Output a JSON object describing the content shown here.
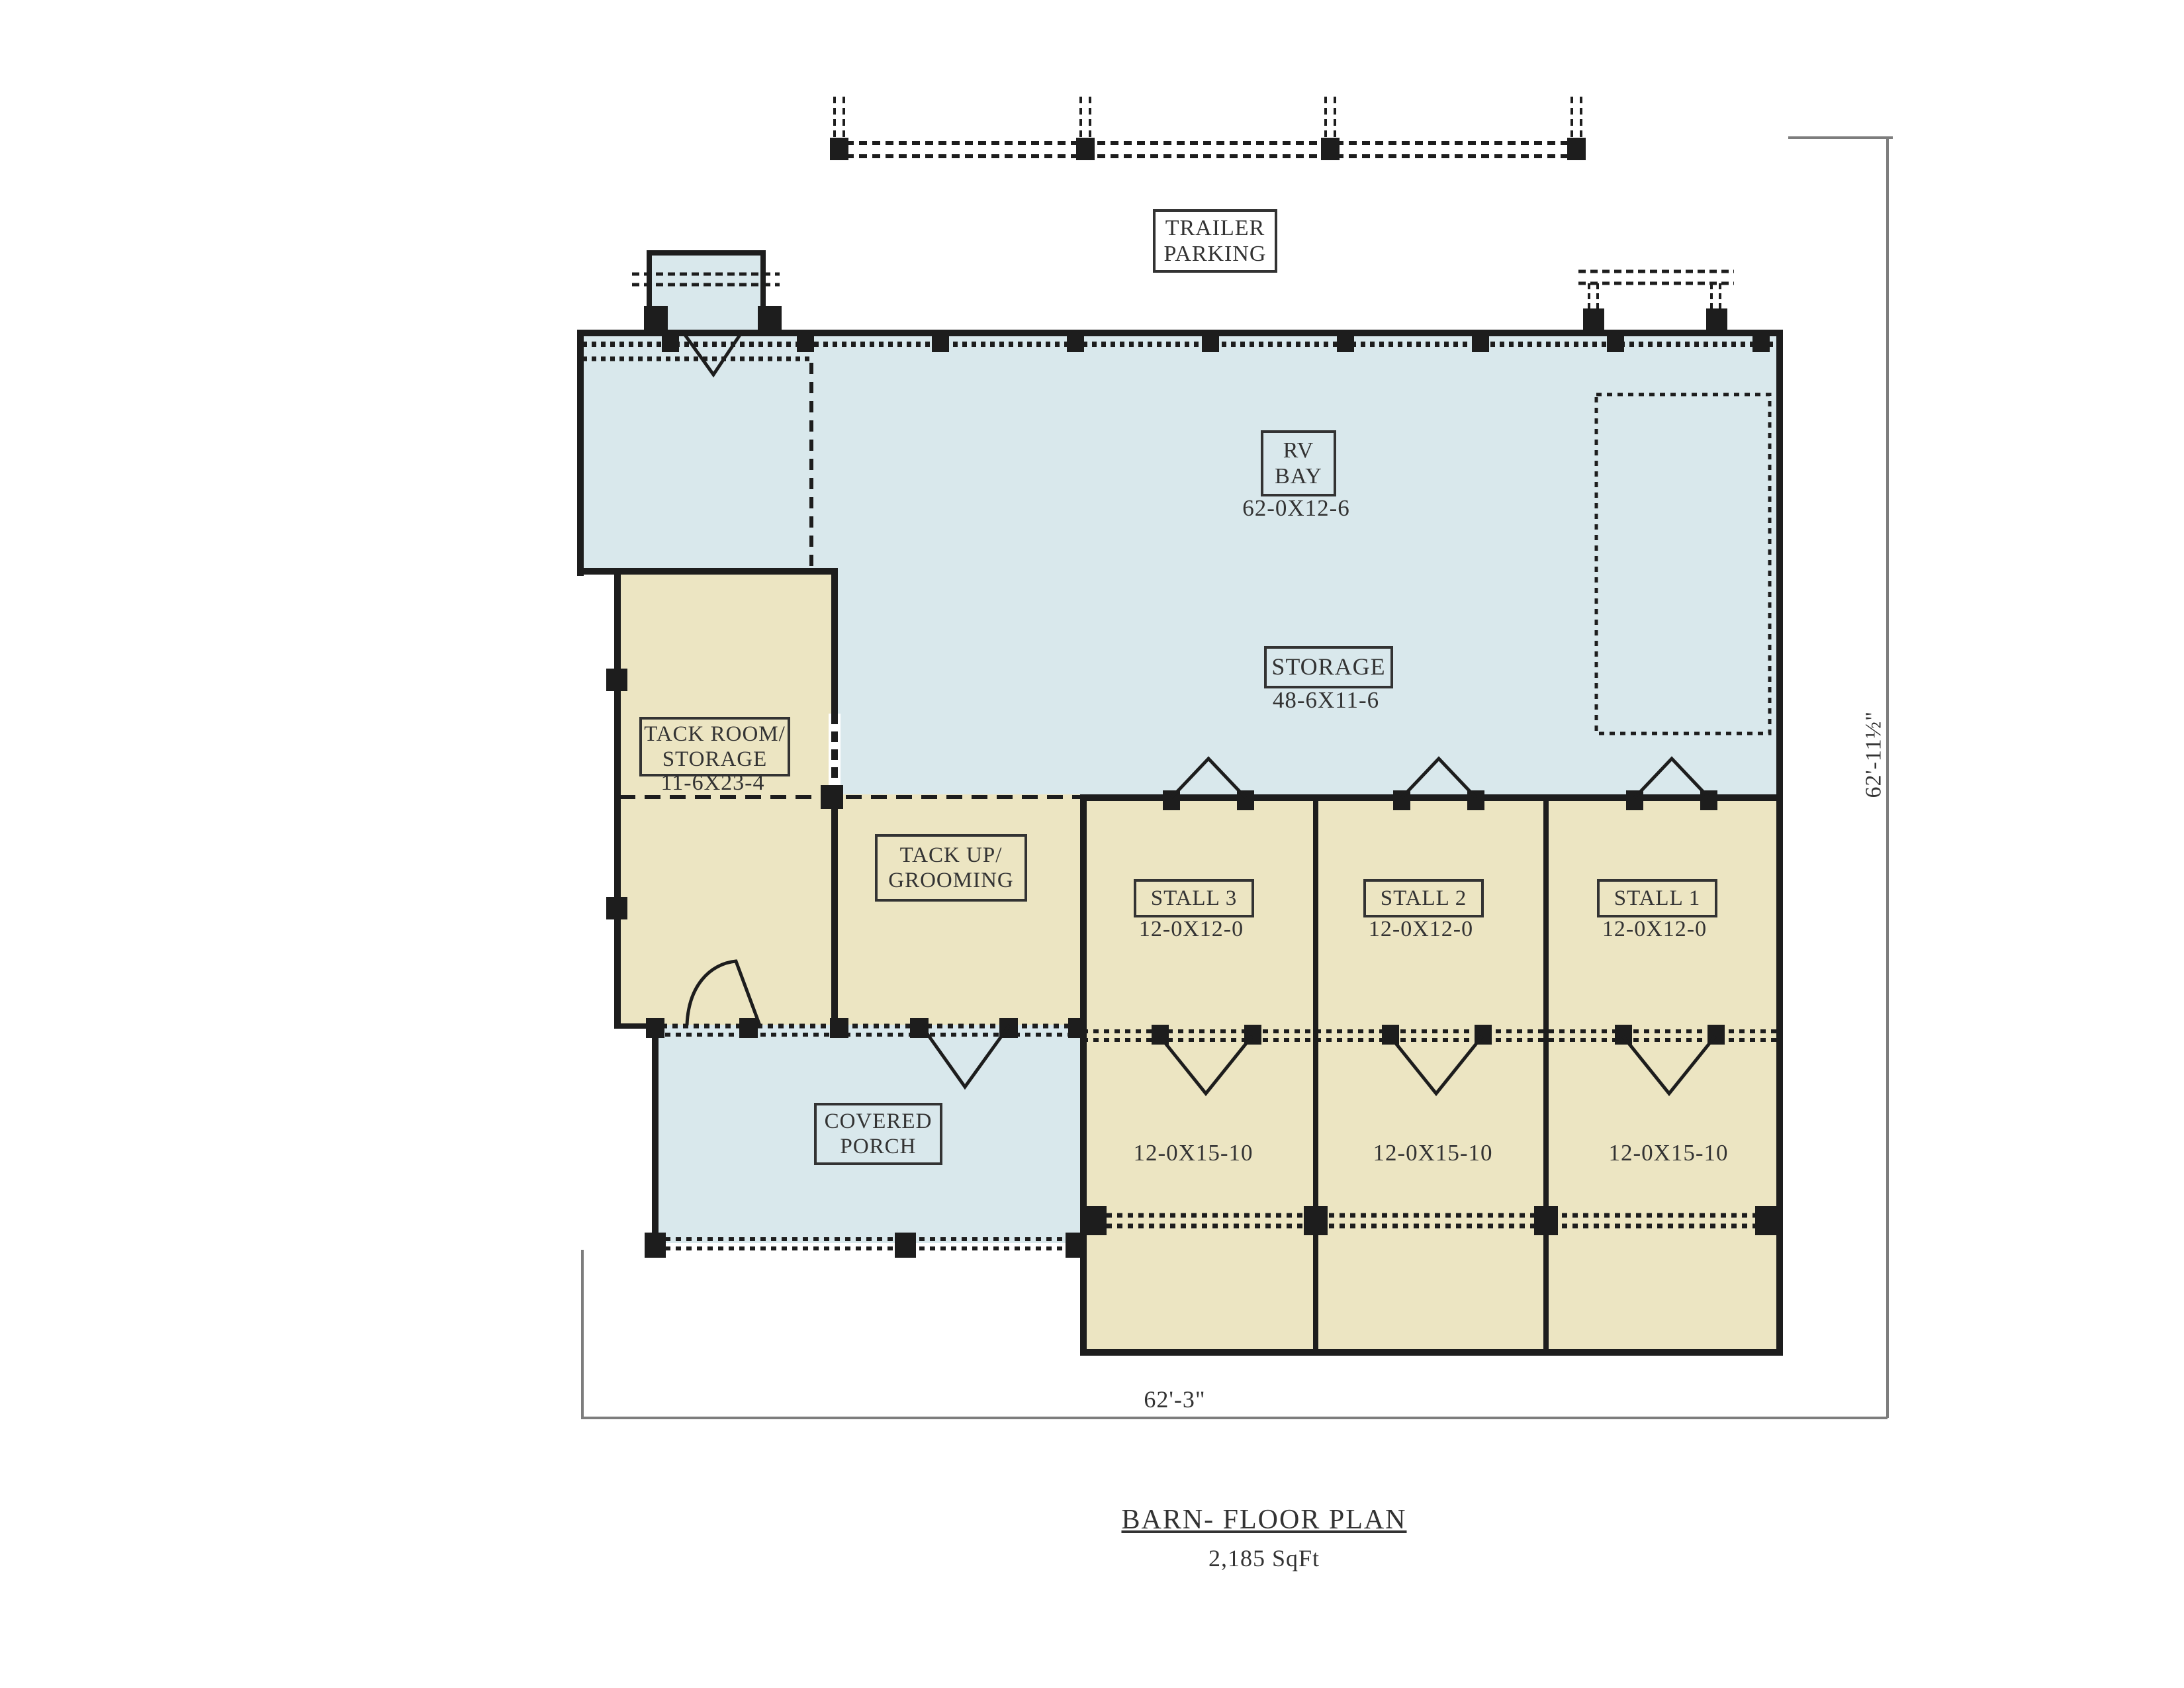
{
  "colors": {
    "blue": "#d9e8ec",
    "cream": "#ece5c2",
    "wall": "#1d1d1d",
    "dim": "#7d7d7d",
    "text": "#333333"
  },
  "rooms": {
    "trailer_parking": {
      "line1": "TRAILER",
      "line2": "PARKING"
    },
    "rv_bay": {
      "line1": "RV",
      "line2": "BAY",
      "dim": "62-0X12-6"
    },
    "storage": {
      "line1": "STORAGE",
      "dim": "48-6X11-6"
    },
    "tack_room": {
      "line1": "TACK ROOM/",
      "line2": "STORAGE",
      "dim": "11-6X23-4"
    },
    "tack_up": {
      "line1": "TACK UP/",
      "line2": "GROOMING"
    },
    "stall3": {
      "line1": "STALL 3",
      "dim": "12-0X12-0"
    },
    "stall2": {
      "line1": "STALL 2",
      "dim": "12-0X12-0"
    },
    "stall1": {
      "line1": "STALL 1",
      "dim": "12-0X12-0"
    },
    "covered_porch": {
      "line1": "COVERED",
      "line2": "PORCH"
    },
    "run3": {
      "dim": "12-0X15-10"
    },
    "run2": {
      "dim": "12-0X15-10"
    },
    "run1": {
      "dim": "12-0X15-10"
    }
  },
  "dimensions": {
    "right": "62'-11½\"",
    "bottom": "62'-3\""
  },
  "title": {
    "name": "BARN- FLOOR PLAN",
    "area": "2,185 SqFt"
  }
}
